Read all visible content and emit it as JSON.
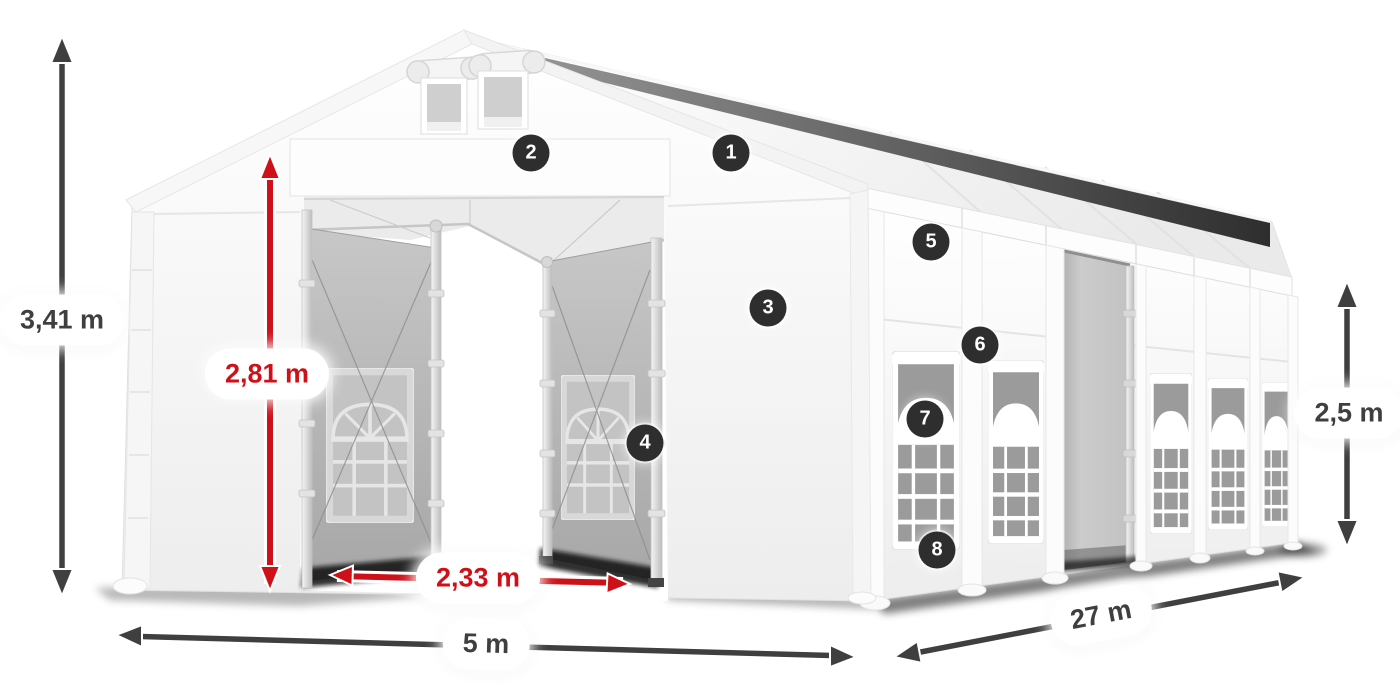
{
  "diagram": {
    "subject": "white marquee tent with open gable entrance, mesh sliding doors and arched side windows",
    "dimension_labels": {
      "total_height": "3,41 m",
      "entrance_height": "2,81 m",
      "entrance_width": "2,33 m",
      "width": "5 m",
      "length": "27 m",
      "side_height": "2,5 m"
    },
    "feature_markers": [
      {
        "label": "1"
      },
      {
        "label": "2"
      },
      {
        "label": "3"
      },
      {
        "label": "4"
      },
      {
        "label": "5"
      },
      {
        "label": "6"
      },
      {
        "label": "7"
      },
      {
        "label": "8"
      }
    ],
    "colors": {
      "red_dimension": "#ce1118",
      "gray_dimension": "#3f3f3f",
      "marker_background": "#2e2e2e",
      "marker_text": "#ffffff",
      "tent_white": "#ffffff",
      "mesh_panel_gray": "#b5b5b5"
    }
  }
}
